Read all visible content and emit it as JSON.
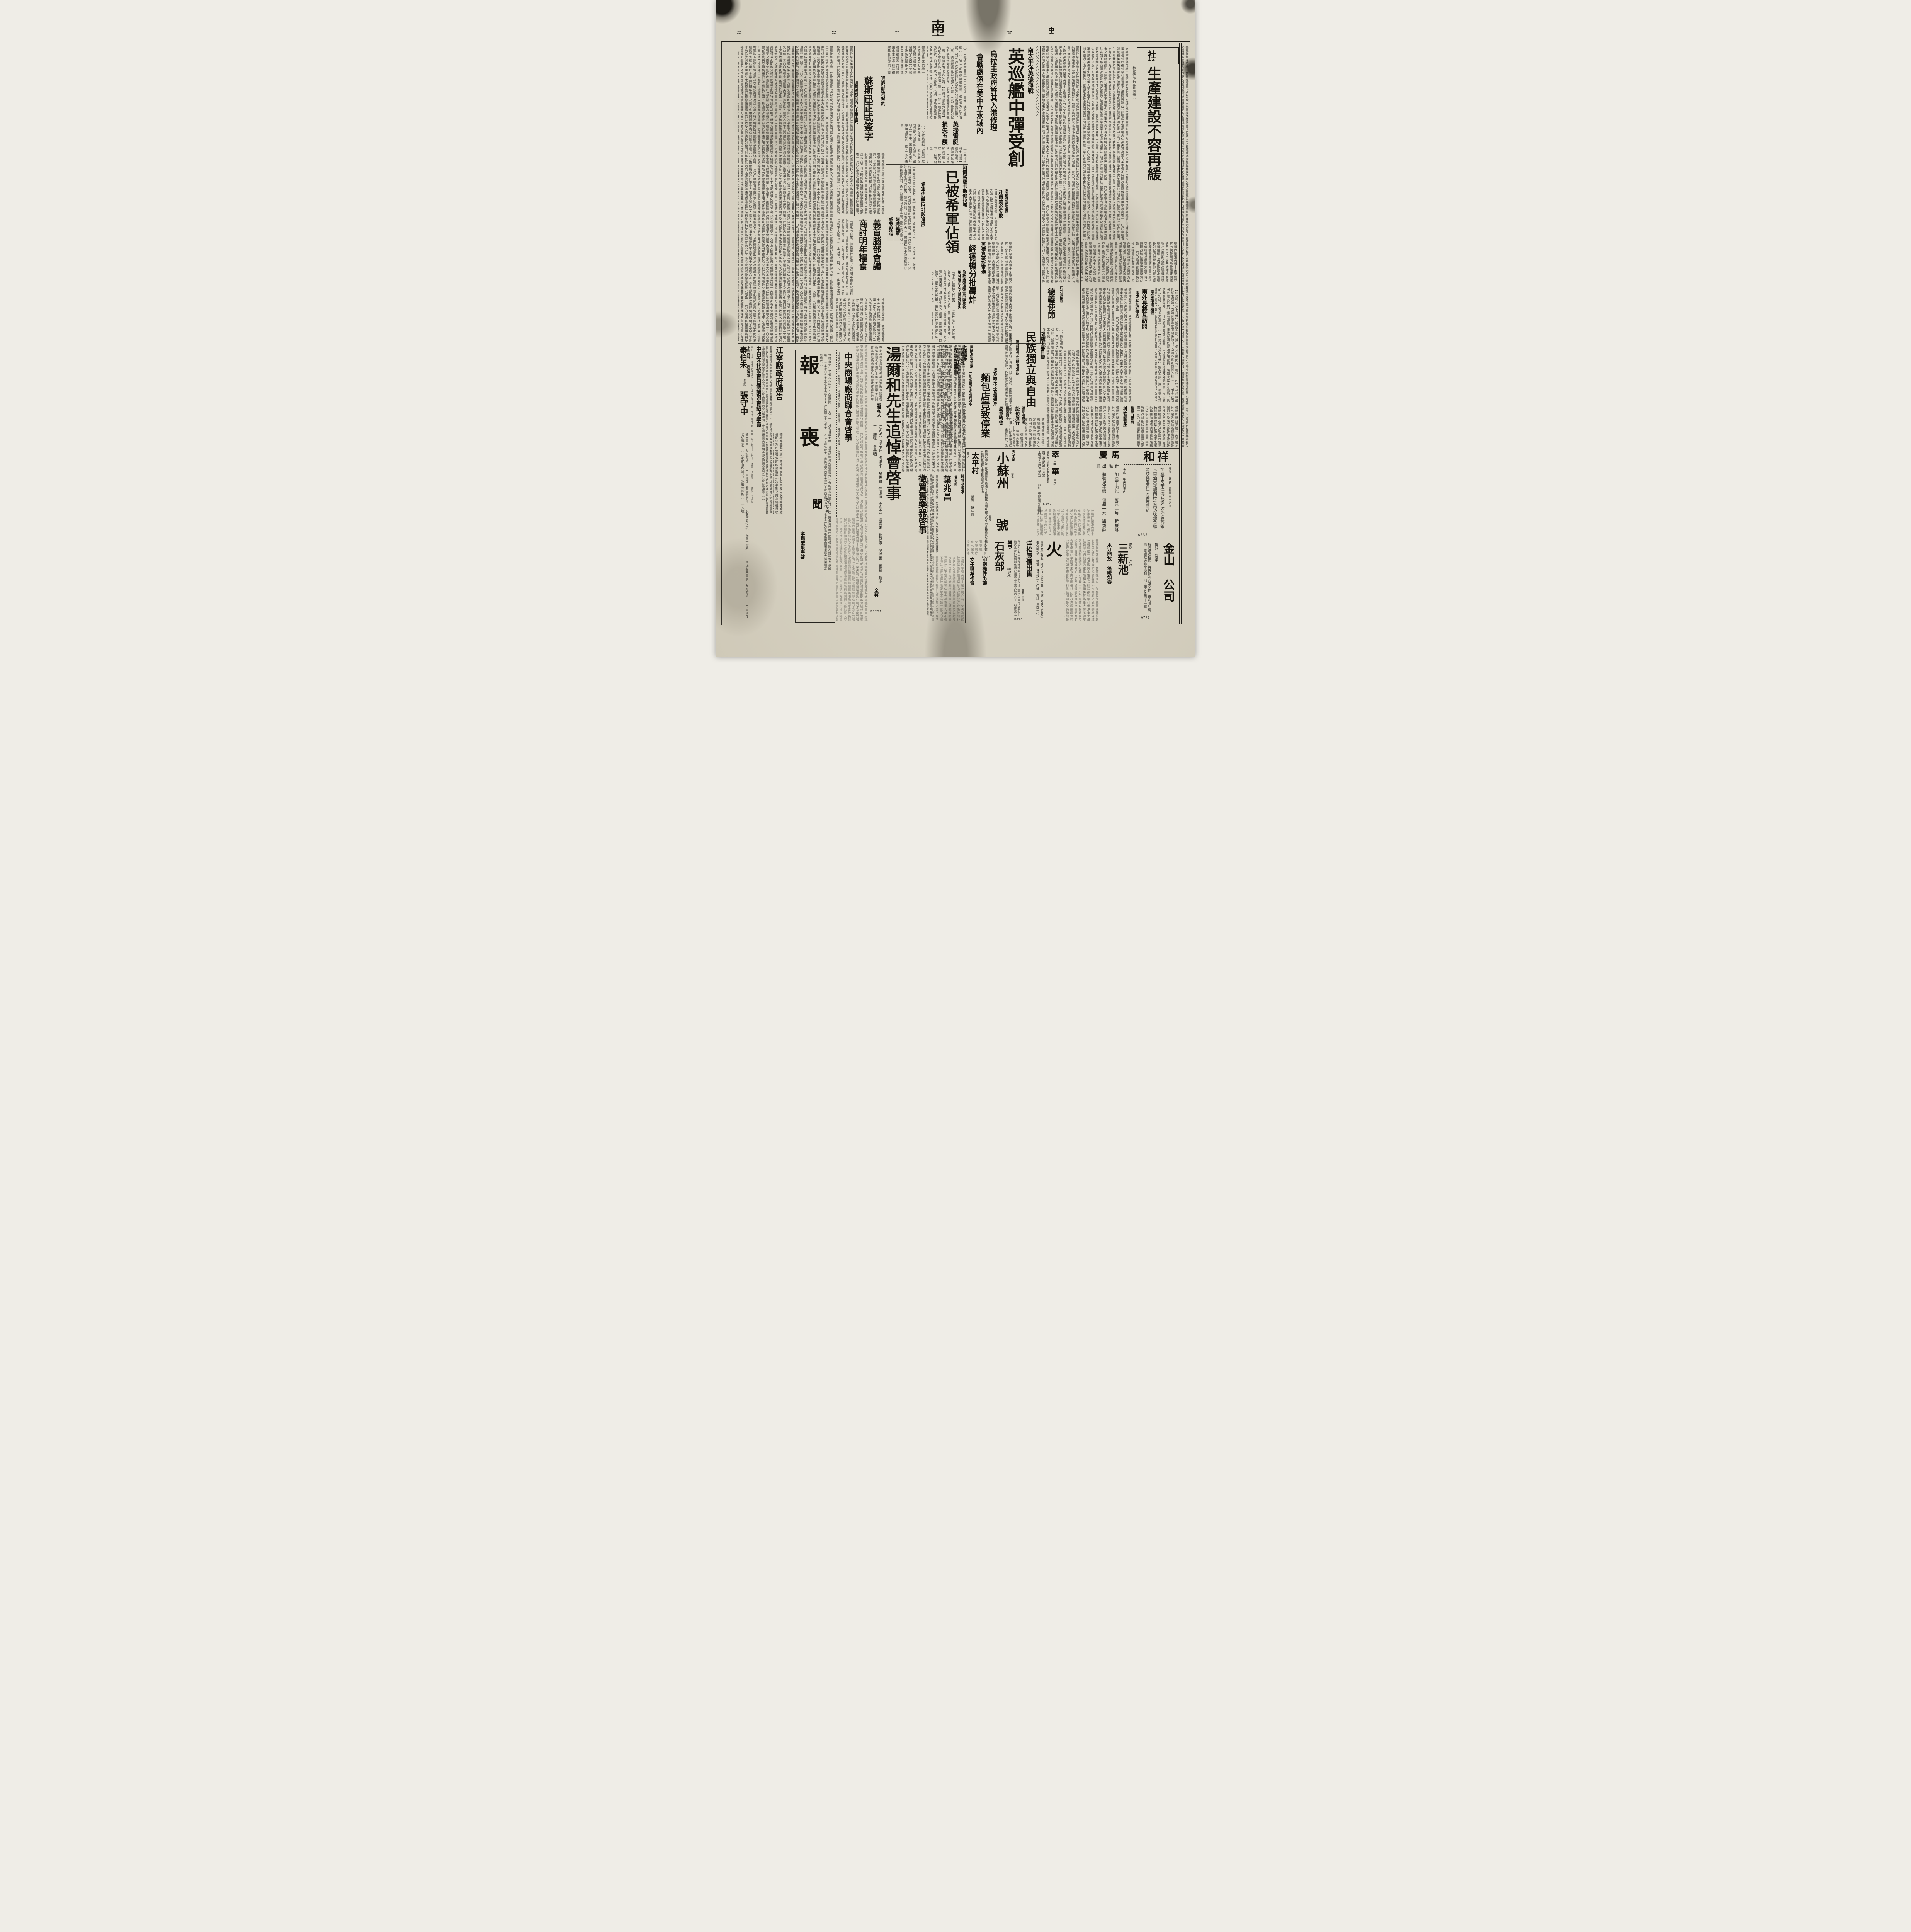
{
  "masthead": {
    "edition": "（第一張第二版）",
    "issue_no": "【第八五〇號】",
    "daily": "【日　刊】",
    "brand": "南京新報",
    "weekday": "【星期日】",
    "date_line": "中華民國二十九年十二月八日"
  },
  "editorial": {
    "label": "社論",
    "title": "生產建設不容再緩",
    "opening": "林宣傳部長五日廣播……",
    "end_mark": "（下）"
  },
  "articles": {
    "naval": {
      "kicker": "南太平洋英德海戰",
      "title": "英巡艦中彈受創",
      "sub1": "烏拉圭政府許其入港修理",
      "sub2": "會戰處係在美中立水域內",
      "body": "【中央社倫敦六日電】英官方今日宣佈、德巡艦一艘……（三）前晚德機襲倫敦、伯明罕及南安普敦、（四）昨晚倫敦與朴次茅斯又成為德機目標、（五）德機繼續在英港敷設水雷、（六）德長射程砲射擊杜佛港東之護航輪、（七）德機昨擊落英機十架、德機亦有七架失蹤、"
    },
    "sweepers": {
      "title1": "英掃雷艇",
      "title2": "損失五艘",
      "body": "【中央社柏林七日電】據海通訊、德海軍當局稱、英損失掃雷艇五艘、其名如下、易西爾號、泰……英倫損失甚為重大、"
    },
    "treaty": {
      "kicker": "通商航海條約",
      "title": "蘇斯已正式簽字",
      "sub": "通商總額四百八十萬金元",
      "note": "上接第一版",
      "body": "【中央社莫斯科七日電】駐在斯洛伐克……蘇聯斯洛伐克間之通商航海條約、最初之一年中、兩國間先實行總額四百八十萬金元之通商、"
    },
    "greece": {
      "kicker": "阿爾格羅卡斯他拉城",
      "title": "已被希軍佔領",
      "sub": "希軍仍續向北段進展",
      "head2a": "阿境義軍",
      "head2b": "感受壓迫",
      "body": "【中央社南國京城七日電】據海通訊、據南斯拉夫……阿爾格羅卡斯他拉城已被希軍佔領、希軍仍繼續向北段進展、義軍感受壓迫……"
    },
    "italy": {
      "title1": "義首腦部會議",
      "title2": "商討明年糧食",
      "body": "【羅馬七日電】據義舉行會議、商討明年糧食及原料供給問題、商業部長雷卡第、農業部長特西勞尼、交通部長費爾、勞工部長甘萊、註冊部長來西、陸軍部長與軍火部長……本月三、四、五……由墨索里尼主持、"
    },
    "portsmouth": {
      "kicker": "英樸資茅斯軍港",
      "title": "經德機分批轟炸",
      "sub1": "倫敦西郊溫莎宮中彈三枚",
      "sub2": "格林威治天文台均受損失",
      "body": "【中央社柏林六日電】……三枚落於王宮技場、當局方面稱、殿幷未受損、但王族等已遭炸……名世界之格林威治天文台、近遭德機空襲、力炸彈及燒夷彈、具有歷史性之建築、旋地球儀、時鐘室、鏡室業已受損、格林威治標準鐘得倖免、"
    },
    "spain": {
      "kicker": "西外長接見",
      "title": "德義使節",
      "body": "【中央社羅馬七日電】路透社訊、據瑪德里來訊、西班牙外長孫納、昨日接見駐西德義大使、"
    },
    "hungary": {
      "kicker": "南匈增進友誼",
      "title": "兩外長將互訪問",
      "sub": "即成立友好條約",
      "body": "【中央社匈京七日電】據海通訊、據「匈牙利新聞報」載稱、南外長卡柯畢最近將來訪匈、南匈有增進友誼關係傾向、南匈外長互訪係答拜……【中央社南國京城六日電】據海通訊、據政界消息靈通方面宣稱、南匈成立友好條約、衆信此為南匈外……決定邀請匈外長赴南、南總理與副總理及外長會商、定日期尚未知悉、官方並未發表……"
    },
    "economy": {
      "kicker": "英經濟調查團",
      "title": "赴南美必失敗",
      "body": "【中央社柏林六日電】此舉與美門羅主義相背、故此次英赴南美之經濟調查團必屬失敗、毫未致慮美國權益、此間政界極感興奮、"
    },
    "yugoslavia": {
      "kicker": "南國主要目標",
      "title": "民族獨立與自由",
      "sub": "南總理在市議會演說",
      "body": "【中央社南國京城七日電】據海通訊、南國總理第柯維支、昨日在此間市議會演說、關於國際政情之演說、各報咸以最顯著地位登載……但南國之主要目標、為民族獨立與自由、政治穩定、與精神團結、始能處理一切懸而未決者、深望以……國民衆廣播、勸青年努力……"
    },
    "finland": {
      "kicker": "芬獨立紀念",
      "title": "希特勒電賀",
      "body": "【中央社柏林七日電】據海通訊、德元首希特勒……芬全國昨舉行國獨立紀念、上午芬京舉行……"
    },
    "quake": {
      "kicker": "南國激烈地震",
      "title": "死傷損失",
      "body": "【南國京城六日電】昨日早晨南部摩斯塔地方、發生激烈地震、但無死傷……"
    },
    "egypt": {
      "kicker": "埃及缺乏之食糧煤斤",
      "title": "麵包店竟致停業",
      "sub": "一切必需品多為英沒收",
      "body": "【中央社開羅七日電】據海通訊、埃及缺乏食糧煤斤、麵包店用棉子餅製……亞歷山大……原料及其他必需品、多為英軍沒收……"
    },
    "romania": {
      "kicker": "羅皇頒令",
      "title": "嚴懲叛徒"
    },
    "portugal_trip": {
      "kicker": "德記者應邀",
      "title": "赴葡旅行"
    },
    "port_police": {
      "kicker": "葡港口警察",
      "title": "搜查輪船"
    }
  },
  "notices": {
    "tang": {
      "title": "湯爾和先生追悼會啓事",
      "body": "華北政務委員會常務委員兼教育總署督辦湯爾和先生頃於本年公忠體國辛亥翊贊共和厥功尤偉乃以積勞致疾遽於本年十一月八日逝世於燕京際茲時艱耆賢凋謝曷勝悼惜爰聯合首都各界假香鋪營中日文化協會舉行追悼大會藉伸追念勳賢之意凡屬湯先生友好以及……唁儀由中日文化協會學術組關宗瑩先生代收是荷",
      "sponsor_label": "發起人",
      "names": "江亢虎　溫宗堯　梅思平　褚民誼　任援道　李聖五　諸青來　趙尊嶽　樊仲雲　張韜　趙正平　唐蟒　秦墨哂",
      "closing": "全啓",
      "code": "B2251"
    },
    "obituary": {
      "big_top": "報",
      "big_bottom": "喪",
      "wen": "聞",
      "body": "金雄白先生之老太太諸太夫人於民國二十九年十二月七日晨七時十分壽終滬寓內寢享壽六十有四歲茲擇於八日下午二時假海格路中國殯儀館大殮諸親友惠臨唁……",
      "note": "恕不另報",
      "signer": "孝錫堂賬房啓"
    },
    "market": {
      "title": "中央商場廠商聯合會啓事",
      "body": "本會舉行大贈獎……諒鑒是幸……"
    },
    "jiangning": {
      "title": "江寧縣政府通告",
      "body": "案准江蘇省公路局業字第六九號函開案准貴縣建字第二……號及牌照各費等由查本縣毘接京畿所有車輛均在南京登記納捐請查照見復為荷等由准此查各即車輛凡在南京市登記納捐範圍在省市互通汽車章程未頒佈前自應遵章登記納捐方符規定准函前由相應函復即希查照辦理見復營業性質大小汽車行駛本縣境內各公路務須一律先行遵章登記繳納季捐及牌照各費方准行駛以符規章……"
    },
    "language_class": {
      "title": "中日文化協會日語講習會招收學員",
      "details": "報名　十二月五日起十三日止　每日上午九至十二時　下午二至五時　時間　晚六時半至八時半　地點　香鋪營……　宗旨　初高級……"
    },
    "doctor": {
      "l1": "上海內科",
      "l2": "調理專家",
      "name1": "秦伯未",
      "mid": "介紹",
      "name2": "張守中",
      "body": "伯未承京中友好邀診……門人張守中君從游多年……必能負所望也。張醫士診所……十八號"
    },
    "instruments": {
      "title": "徵買舊樂器啓事"
    },
    "accountant": {
      "label": "會計師",
      "name": "葉兆昌"
    },
    "chen": {
      "title": "陳性初啓事"
    },
    "women": {
      "title": "女子職業福音"
    },
    "print_sale": {
      "title": "印刷機件出讓"
    }
  },
  "ads": {
    "xianghe": {
      "n1": "祥",
      "n2": "和",
      "store": "總店　中華路　電話二三二八九一",
      "products": [
        "加厘牛肉",
        "華洋海味",
        "松仁交切",
        "參燕銀耳",
        "蓽油米花糖",
        "四時水果",
        "透味燻魚",
        "聽裝茶葉",
        "五香牛肉",
        "香煙雪茄"
      ],
      "branch": "支店　中央商場內",
      "code": "A535"
    },
    "jinshan": {
      "name": "金山",
      "labels": "機器　洗染",
      "name2": "公司",
      "lines": "特聘港滬技師　特快乾洗八時交件　專洗呢毛綢緞　電話取送非常便利　地址國府路四十一號",
      "code": "A778"
    },
    "ma": {
      "name": "馬",
      "lines": "新　加厘牛肉包　每只二角　新鮮酥脆"
    },
    "qing": {
      "name": "慶",
      "lines": "出　瓶裝果子醬　每瓶一元　甜香酥脆"
    },
    "cuihua": {
      "n1": "萃",
      "s1": "品",
      "n2": "華",
      "s2": "商店",
      "p0": "新各色沙利文聽裝餅乾",
      "p1": "紅黑老牌威士克酒",
      "p2": "上等亨白牌雪茄煙",
      "addr": "地址：中山路珠江路西口",
      "code": "A357"
    },
    "taiping": {
      "name": "太平村",
      "sub": "支店",
      "products": "醬鴨　醬牛肉"
    },
    "xiaosuzhou": {
      "kicker": "夫子廟",
      "name": "小蘇州",
      "t1": "茶食",
      "t2": "糖果",
      "t3": "號",
      "products": [
        "特製奶油瓜子",
        "豬油芙蓉酥",
        "蓽油米花糖",
        "松子澆切片",
        "甜心巧克力",
        "各種蓽素酥糖",
        "可可黃豆糖",
        "代售福建土產",
        "自製透味醬牛肉"
      ],
      "code": "A534"
    },
    "fire": {
      "name": "火",
      "lines": "惠顧無任歡迎　總公司：上海外灘１８號　南京：南英保泰保險公司　地址：珠江路一六〇號　電話二三四一〇"
    },
    "pine": {
      "title": "洋松廉價出售",
      "intro": "茲有大批",
      "body": "洋松大小自三寸六寸起至八寸十六寸止長短自數尺起至七十餘尺止分批廉價出售用戶請駕至本京大板巷八十九號建業公司接洽可也",
      "code": "B247"
    },
    "lime": {
      "n1": "興亞",
      "name": "石灰部",
      "sub": "營業"
    },
    "sanxin": {
      "name": "三新池",
      "s1": "盆浴",
      "s2": "汽水",
      "lines": "水汀開放　溫暖如春"
    }
  },
  "ornaments": {
    "zigzag": "〉"
  },
  "filler": "德機昨擊落英機十架德機亦有七架失蹤前晚德機襲倫敦伯明罕及南安普敦昨晚倫敦與朴次茅斯又成為德機目標德機繼續在英港敷設水雷德長射程砲射擊杜佛港東之護航輪據海通訊德海軍當局稱英倫損失甚為重大英不得不時時改繞航線德潛艇擊沉商輪一三〇〇噸德官報載稱英損失掃雷艇五艘其名如下易西爾號據政界消息靈通方面宣稱衆信此舉頗毫未致慮美國權益此間政界極感興奮茲此舉行會議商討明年糧食及原料供給問題敵交通綫與敵兵營在北非方面敵機向我托不魯克地帶投彈死二人傷五人餘無損失"
}
